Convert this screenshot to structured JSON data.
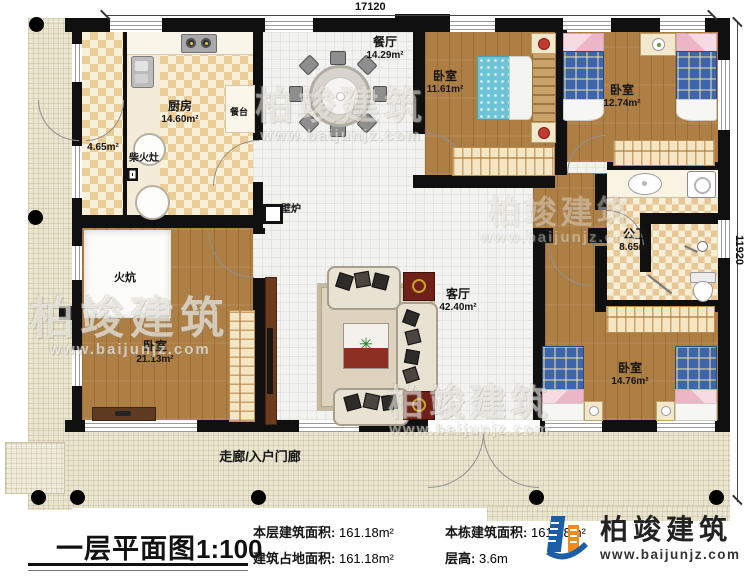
{
  "dimensions": {
    "top": "17120",
    "right": "11920"
  },
  "rooms": {
    "kitchen": {
      "name": "厨房",
      "area": "14.60m²"
    },
    "pantry": {
      "area": "4.65m²"
    },
    "dining": {
      "name": "餐厅",
      "area": "14.29m²"
    },
    "living": {
      "name": "客厅",
      "area": "42.40m²"
    },
    "bedroom_nw": {
      "name": "卧室",
      "area": "11.61m²"
    },
    "bedroom_ne": {
      "name": "卧室",
      "area": "12.74m²"
    },
    "bathroom": {
      "name": "公卫",
      "area": "8.65m²"
    },
    "bedroom_se": {
      "name": "卧室",
      "area": "14.76m²"
    },
    "bedroom_sw": {
      "name": "卧室",
      "area": "21.13m²"
    }
  },
  "fixtures": {
    "wood_stove": "柴火灶",
    "counter": "餐台",
    "fireplace": "壁炉",
    "kang": "火炕",
    "porch": "走廊/入户门廊"
  },
  "icons": {
    "plant": "✳"
  },
  "footer": {
    "title": "一层平面图",
    "scale": "1:100",
    "stats": [
      {
        "label": "本层建筑面积:",
        "value": "161.18m²"
      },
      {
        "label": "本栋建筑面积:",
        "value": "161.18m²"
      },
      {
        "label": "建筑占地面积:",
        "value": "161.18m²"
      },
      {
        "label": "层高:",
        "value": "3.6m"
      }
    ]
  },
  "brand": {
    "name": "柏竣建筑",
    "site": "www.baijunjz.com"
  },
  "watermark": {
    "name": "柏竣建筑",
    "site": "www.baijunjz.com"
  }
}
